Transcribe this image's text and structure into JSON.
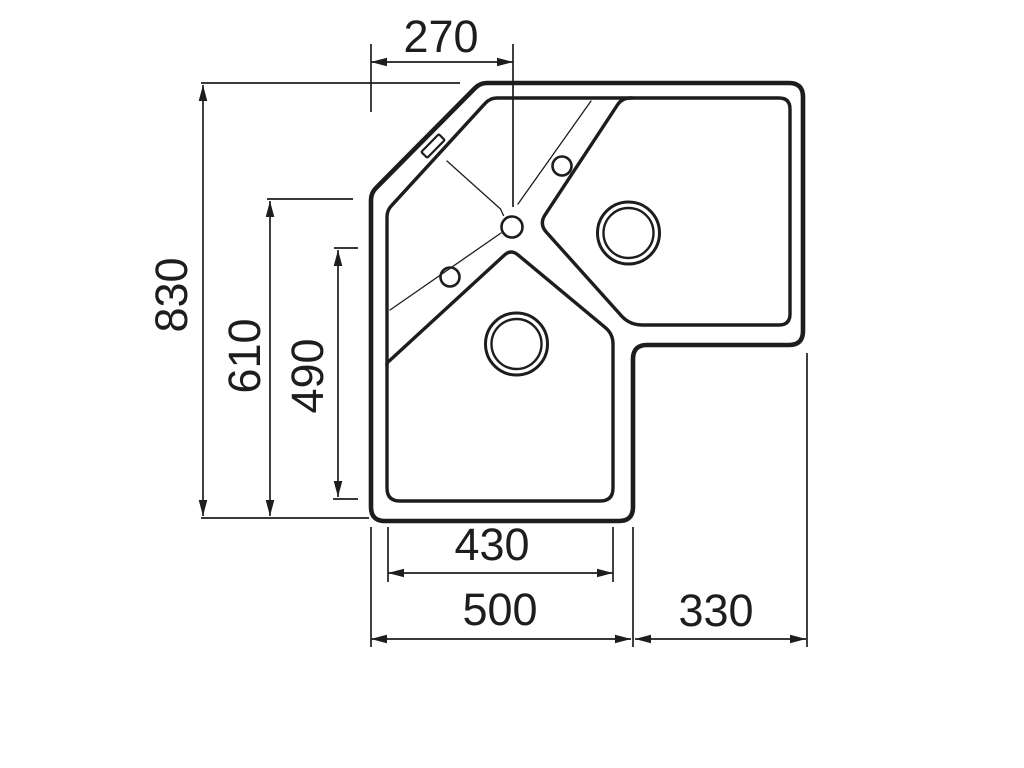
{
  "drawing": {
    "subject": "Corner kitchen sink top-view technical drawing",
    "line_color": "#1d1d1b",
    "background_color": "#ffffff",
    "dimensions": {
      "top_left_offset": "270",
      "overall_depth": "830",
      "left_side_height": "610",
      "left_bowl_depth": "490",
      "left_bowl_width": "430",
      "bottom_left_width": "500",
      "bottom_right_width": "330"
    }
  }
}
